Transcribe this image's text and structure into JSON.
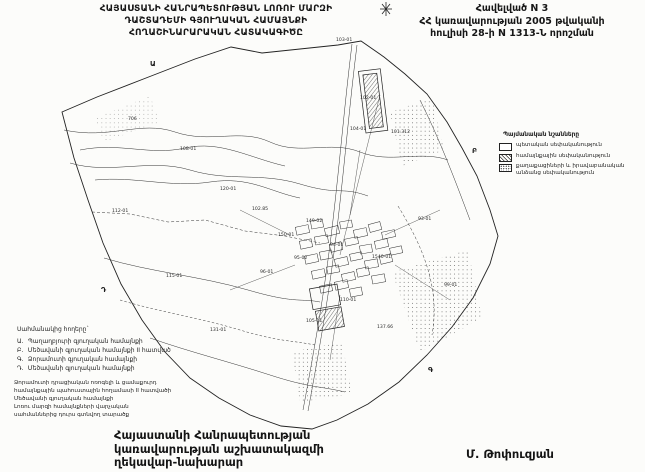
{
  "page": {
    "background": "#fcfcfa",
    "ink": "#1f1f1f"
  },
  "header": {
    "title_lines": [
      "ՀԱՅԱՍՏԱՆԻ ՀԱՆՐԱՊԵՏՈՒԹՅԱՆ ԼՈՌՈՒ ՄԱՐԶԻ",
      "ԴԱՇՏԱԴԵՄԻ ԳՅՈՒՂԱԿԱՆ ՀԱՄԱՅՆՔԻ",
      "ՀՈՂԱՇԻՆԱՐԱՐԱԿԱՆ ՀԱՏԱԿԱԳԻԾԸ"
    ],
    "appendix_lines": [
      "Հավելված N 3",
      "ՀՀ կառավարության 2005 թվականի",
      "հուլիսի 28-ի N 1313-Ն որոշման"
    ]
  },
  "legend_box": {
    "title": "Պայմանական նշանները",
    "items": [
      {
        "swatch": "empty",
        "label": "պետական սեփականություն"
      },
      {
        "swatch": "hatched",
        "label": "համայնքային սեփականություն"
      },
      {
        "swatch": "stippled",
        "label": "քաղաքացիների և իրավաբանական անձանց սեփականություն"
      }
    ]
  },
  "adjacent_block": {
    "title": "Սահմանակից հողերը`",
    "items": [
      {
        "marker": "Ա.",
        "label": "Պաղաղբյուրի գյուղական համայնքի"
      },
      {
        "marker": "Բ.",
        "label": "Մեծավանի գյուղական համայնքի II հատված"
      },
      {
        "marker": "Գ.",
        "label": "Ձորամուտի գյուղական համայնքի"
      },
      {
        "marker": "Դ.",
        "label": "Մեծավանի գյուղական համայնքի"
      }
    ]
  },
  "notes_block": {
    "lines": [
      "Ձորամուտի դրացիական ոռոգելի և ցամաքուրդ",
      "համայնքային պահուստային հողամասի II հատվածի",
      "Մեծավանի գյուղական համայնքի",
      "Լոռու մարզի համայնքների վարչական",
      "սահմաններից դուրս գտնվող տարածք"
    ]
  },
  "office": {
    "lines": [
      "Հայաստանի Հանրապետության",
      "կառավարության աշխատակազմի",
      "ղեկավար-նախարար"
    ]
  },
  "signature": {
    "name": "Մ. Թոփուզյան"
  },
  "map": {
    "parcel_labels": [
      {
        "text": "103-01",
        "x": 336,
        "y": 41
      },
      {
        "text": "102-01",
        "x": 360,
        "y": 99
      },
      {
        "text": "104-01",
        "x": 350,
        "y": 130
      },
      {
        "text": "101.312",
        "x": 391,
        "y": 133
      },
      {
        "text": "706",
        "x": 128,
        "y": 120
      },
      {
        "text": "108-01",
        "x": 180,
        "y": 150
      },
      {
        "text": "112-01",
        "x": 112,
        "y": 212
      },
      {
        "text": "120-01",
        "x": 220,
        "y": 190
      },
      {
        "text": "102.85",
        "x": 252,
        "y": 210
      },
      {
        "text": "149-02",
        "x": 306,
        "y": 222
      },
      {
        "text": "150-01",
        "x": 278,
        "y": 236
      },
      {
        "text": "94-01",
        "x": 330,
        "y": 246
      },
      {
        "text": "95-02",
        "x": 294,
        "y": 259
      },
      {
        "text": "1540-01",
        "x": 372,
        "y": 258
      },
      {
        "text": "93-01",
        "x": 418,
        "y": 220
      },
      {
        "text": "99-01",
        "x": 444,
        "y": 286
      },
      {
        "text": "96-01",
        "x": 260,
        "y": 273
      },
      {
        "text": "110-01",
        "x": 340,
        "y": 301
      },
      {
        "text": "105-01",
        "x": 306,
        "y": 322
      },
      {
        "text": "137.66",
        "x": 377,
        "y": 328
      },
      {
        "text": "131-01",
        "x": 210,
        "y": 331
      },
      {
        "text": "115-01",
        "x": 166,
        "y": 277
      }
    ],
    "edge_letters": [
      {
        "text": "Ա",
        "x": 150,
        "y": 66
      },
      {
        "text": "Բ",
        "x": 472,
        "y": 153
      },
      {
        "text": "Գ",
        "x": 428,
        "y": 372
      },
      {
        "text": "Դ",
        "x": 101,
        "y": 292
      }
    ]
  }
}
